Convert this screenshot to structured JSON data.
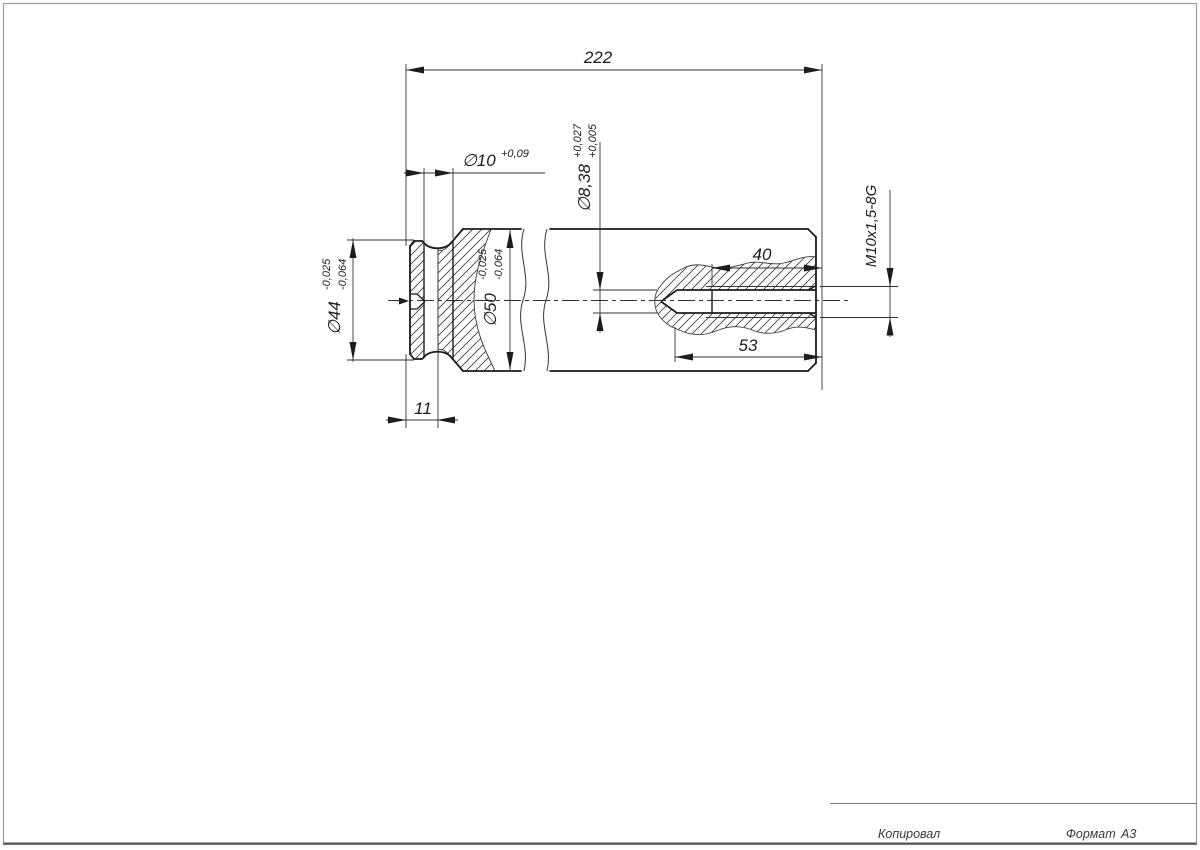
{
  "dimensions": {
    "overall_length": "222",
    "groove": {
      "main": "∅10",
      "tol": "+0,09"
    },
    "pilot_hole": {
      "main": "∅8,38",
      "tol_upper": "+0,027",
      "tol_lower": "+0,005"
    },
    "thread_spec": "M10x1,5-8G",
    "thread_depth": "40",
    "hole_depth": "53",
    "collar_dia": {
      "main": "∅44",
      "tol_upper": "-0,025",
      "tol_lower": "-0,064"
    },
    "body_dia": {
      "main": "∅50",
      "tol_upper": "-0,025",
      "tol_lower": "-0,064"
    },
    "groove_offset": "11"
  },
  "stamp": {
    "copied_label": "Копировал",
    "format_label": "Формат",
    "format_value": "А3"
  },
  "colors": {
    "line": "#1c1c1c",
    "thin_line": "#333333",
    "border": "#999999"
  }
}
